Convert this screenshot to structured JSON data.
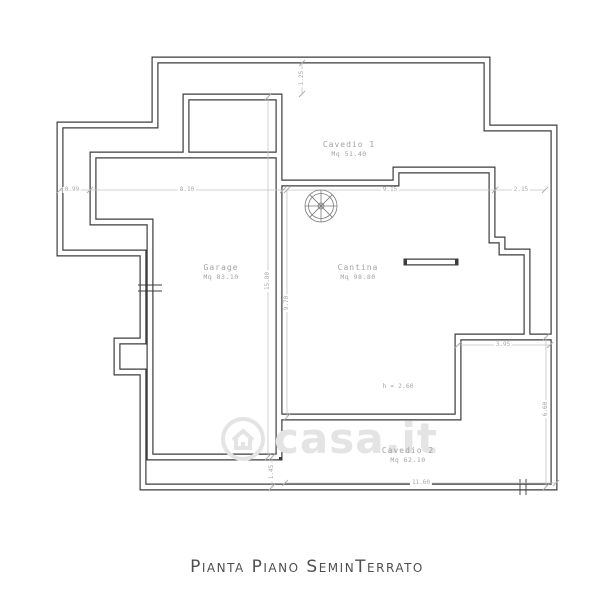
{
  "title": {
    "text": "Pianta Piano SeminTerrato"
  },
  "watermark": {
    "text": "casa.it",
    "icon": "house-in-circle-logo"
  },
  "plan": {
    "rooms": [
      {
        "name": "Cavedio 1",
        "area": "Mq 51.40"
      },
      {
        "name": "Garage",
        "area": "Mq 83.10"
      },
      {
        "name": "Cantina",
        "area": "Mq 98.80"
      },
      {
        "name": "Cavedio 2",
        "area": "Mq 62.10"
      }
    ],
    "height_note": "h = 2.60",
    "dimensions": {
      "top": [
        "0.99",
        "8.10",
        "9.15",
        "2.15"
      ],
      "upper_center_vertical": "1.25",
      "left_vertical": "15.80",
      "center_vertical": "9.70",
      "right_horizontal": "3.95",
      "right_vertical": "6.60",
      "bottom_horizontal": "11.60",
      "bottom_left_vertical": "1.45"
    },
    "colors": {
      "wall": "#3c3c3c",
      "dimension_line": "#c4c4c4",
      "label_text": "#a3a3a3",
      "watermark": "#e4e4e4"
    }
  }
}
